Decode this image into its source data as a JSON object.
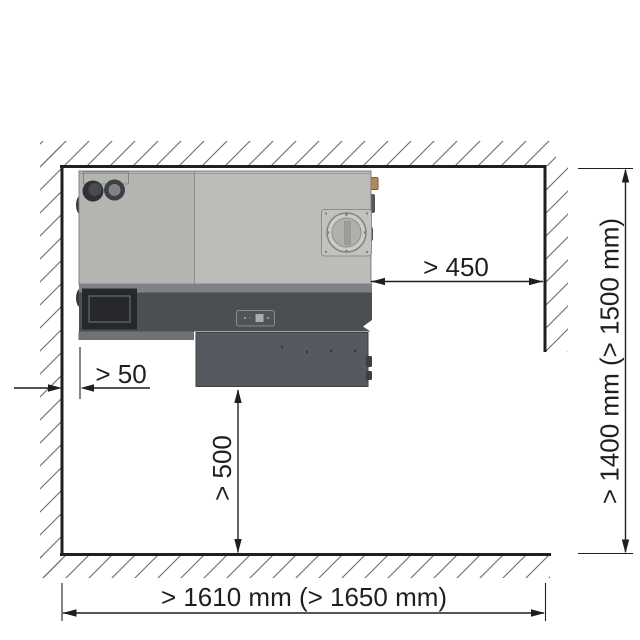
{
  "diagram": {
    "title": "installation-clearance-top-view",
    "labels": {
      "clearance_right": "> 450",
      "clearance_left": "> 50",
      "clearance_front": "> 500",
      "room_depth": "> 1400 mm (> 1500 mm)",
      "room_width": "> 1610 mm (> 1650 mm)"
    },
    "colors": {
      "line": "#1f1f1f",
      "hatch": "#6a6a6a",
      "unit_body": "#b4b4b0",
      "unit_body_light": "#bcbcb8",
      "unit_strip": "#7f8184",
      "unit_band": "#4b4e53",
      "unit_panel": "#26282b",
      "unit_lip": "#6f7276",
      "unit_box": "#565a60",
      "port_plate": "#c2c2be",
      "port_ring": "#cbcbc7",
      "connector_tan": "#b28a5c"
    }
  }
}
